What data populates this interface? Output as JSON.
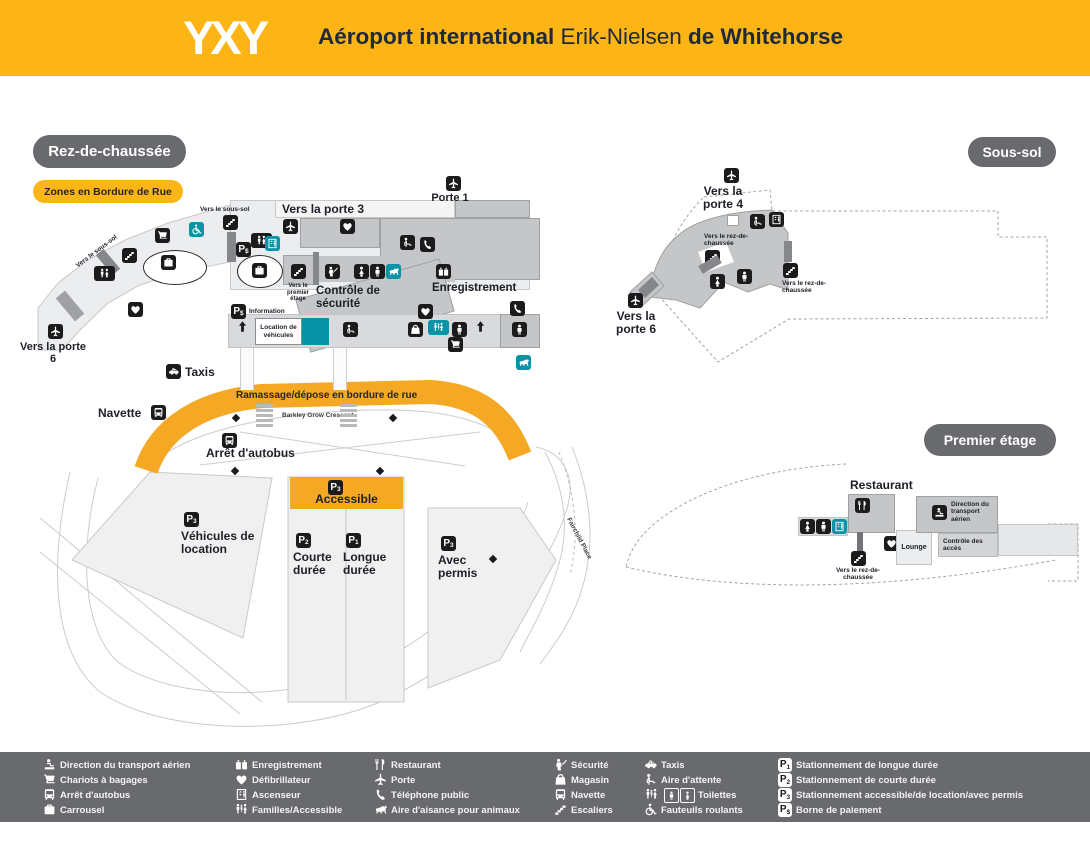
{
  "header": {
    "logo": "YXY",
    "title_part1": "Aéroport international",
    "title_part2": " Erik-Nielsen ",
    "title_part3": "de Whitehorse"
  },
  "badges": {
    "ground_floor": "Rez-de-chaussée",
    "basement": "Sous-sol",
    "first_floor": "Premier étage",
    "curbside_zones": "Zones en Bordure de Rue"
  },
  "ground_floor": {
    "to_gate3": "Vers la porte 3",
    "gate1": "Porte 1",
    "to_basement_top": "Vers le sous-sol",
    "to_basement_curve": "Vers le sous-sol",
    "to_first_floor": "Vers le premier étage",
    "security": "Contrôle de sécurité",
    "checkin": "Enregistrement",
    "information": "Information",
    "car_rental": "Location de véhicules",
    "to_gate6": "Vers la porte 6",
    "taxis": "Taxis",
    "shuttle": "Navette",
    "bus_stop": "Arrêt d'autobus",
    "curbside_pickup": "Ramassage/dépose en bordure de rue",
    "street1": "Barkley Grow Crescent",
    "street2": "Fairchild Place",
    "parking_accessible": "Accessible",
    "parking_short": "Courte durée",
    "parking_long": "Longue durée",
    "parking_permit": "Avec permis",
    "parking_rental": "Véhicules de location"
  },
  "basement": {
    "to_gate4": "Vers la porte 4",
    "to_gate6": "Vers la porte 6",
    "to_ground1": "Vers le rez-de-chaussée",
    "to_ground2": "Vers le rez-de-chaussée"
  },
  "first_floor": {
    "restaurant": "Restaurant",
    "lounge": "Lounge",
    "airport_admin": "Direction du transport aérien",
    "access_control": "Contrôle des accès",
    "to_ground": "Vers le rez-de-chaussée"
  },
  "p_icons": {
    "long": {
      "p": "P",
      "sub": "1"
    },
    "short": {
      "p": "P",
      "sub": "2"
    },
    "accessible": {
      "p": "P",
      "sub": "3"
    },
    "pay": {
      "p": "P",
      "sub": "$"
    }
  },
  "legend": {
    "col1": [
      {
        "icon": "airport-administration",
        "label": "Direction du transport aérien"
      },
      {
        "icon": "baggage-carts",
        "label": "Chariots à bagages"
      },
      {
        "icon": "bus-stop",
        "label": "Arrêt d'autobus"
      },
      {
        "icon": "carousel",
        "label": "Carrousel"
      }
    ],
    "col2": [
      {
        "icon": "check-in",
        "label": "Enregistrement"
      },
      {
        "icon": "defibrillator",
        "label": "Défibrillateur"
      },
      {
        "icon": "elevator",
        "label": "Ascenseur"
      },
      {
        "icon": "families-accessible",
        "label": "Familles/Accessible"
      }
    ],
    "col3": [
      {
        "icon": "restaurant",
        "label": "Restaurant"
      },
      {
        "icon": "gate",
        "label": "Porte"
      },
      {
        "icon": "public-phone",
        "label": "Téléphone public"
      },
      {
        "icon": "pet-relief-area",
        "label": "Aire d'aisance pour animaux"
      }
    ],
    "col4": [
      {
        "icon": "security",
        "label": "Sécurité"
      },
      {
        "icon": "shop",
        "label": "Magasin"
      },
      {
        "icon": "shuttle",
        "label": "Navette"
      },
      {
        "icon": "stairs",
        "label": "Escaliers"
      }
    ],
    "col5": [
      {
        "icon": "taxis",
        "label": "Taxis"
      },
      {
        "icon": "waiting-area",
        "label": "Aire d'attente"
      },
      {
        "icon": "toilets",
        "label": "Toilettes"
      },
      {
        "icon": "wheelchairs",
        "label": "Fauteuils roulants"
      }
    ],
    "col6": [
      {
        "icon": "parking-long",
        "badge": "P",
        "sub": "1",
        "label": "Stationnement de longue durée"
      },
      {
        "icon": "parking-short",
        "badge": "P",
        "sub": "2",
        "label": "Stationnement de courte durée"
      },
      {
        "icon": "parking-accessible",
        "badge": "P",
        "sub": "3",
        "label": "Stationnement accessible/de location/avec permis"
      },
      {
        "icon": "pay-station",
        "badge": "P",
        "sub": "$",
        "label": "Borne de paiement"
      }
    ]
  },
  "colors": {
    "header_yellow": "#FDB415",
    "curb_yellow": "#F5A823",
    "pill_gray": "#696A6D",
    "teal": "#0894A6",
    "icon_black": "#1B1B1D"
  }
}
